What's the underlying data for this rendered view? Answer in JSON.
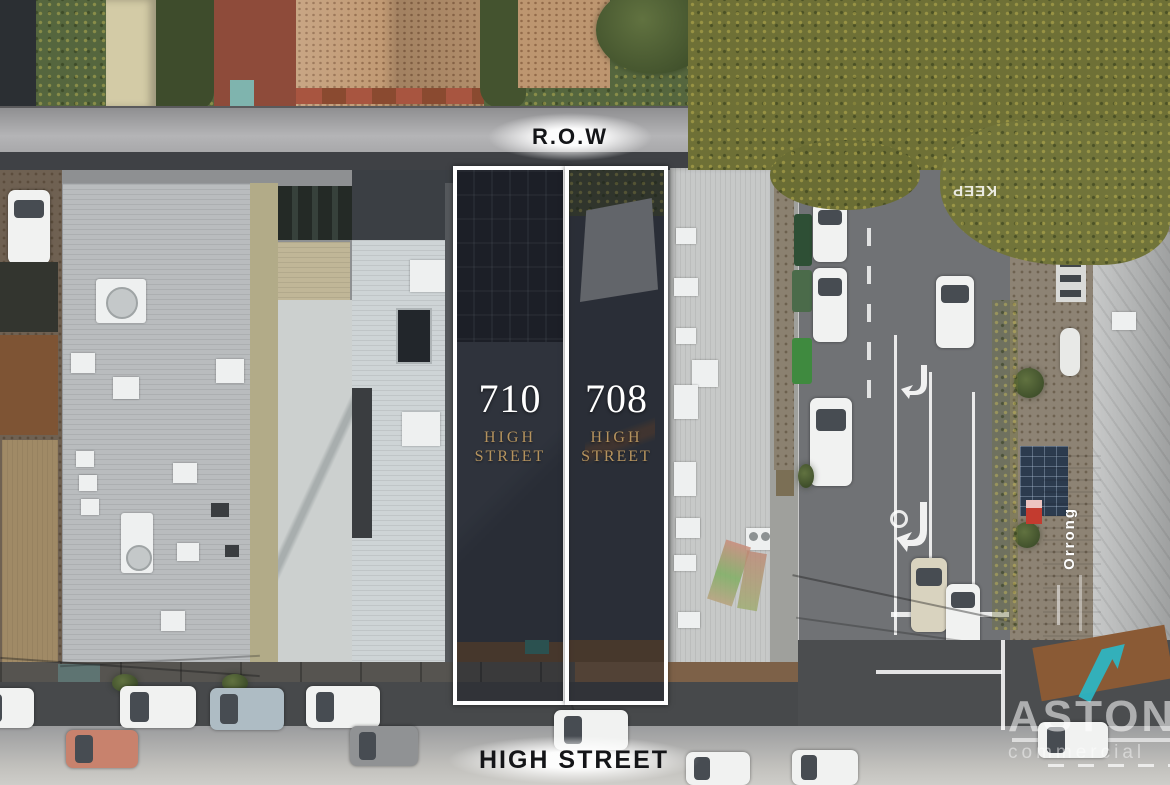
{
  "scene": {
    "description": "Aerial drone photograph of two commercial properties at 710 and 708 High Street outlined in white, between a rear right-of-way laneway and High Street",
    "colors": {
      "boundary_outline": "#ffffff",
      "property_overlay": "rgba(14,17,26,0.38)",
      "gold_text": "#b5935e",
      "aston_teal": "#2bb7c6",
      "awning_orange": "#b4662e"
    }
  },
  "labels": {
    "row": "R.O.W",
    "high_street": "HIGH STREET"
  },
  "properties": [
    {
      "number": "710",
      "line1": "HIGH",
      "line2": "STREET"
    },
    {
      "number": "708",
      "line1": "HIGH",
      "line2": "STREET"
    }
  ],
  "road_markings": {
    "keep": "KEEP"
  },
  "signage": {
    "orrong": "Orrong"
  },
  "watermark": {
    "brand": "ASTON",
    "subtitle": "commercial"
  }
}
